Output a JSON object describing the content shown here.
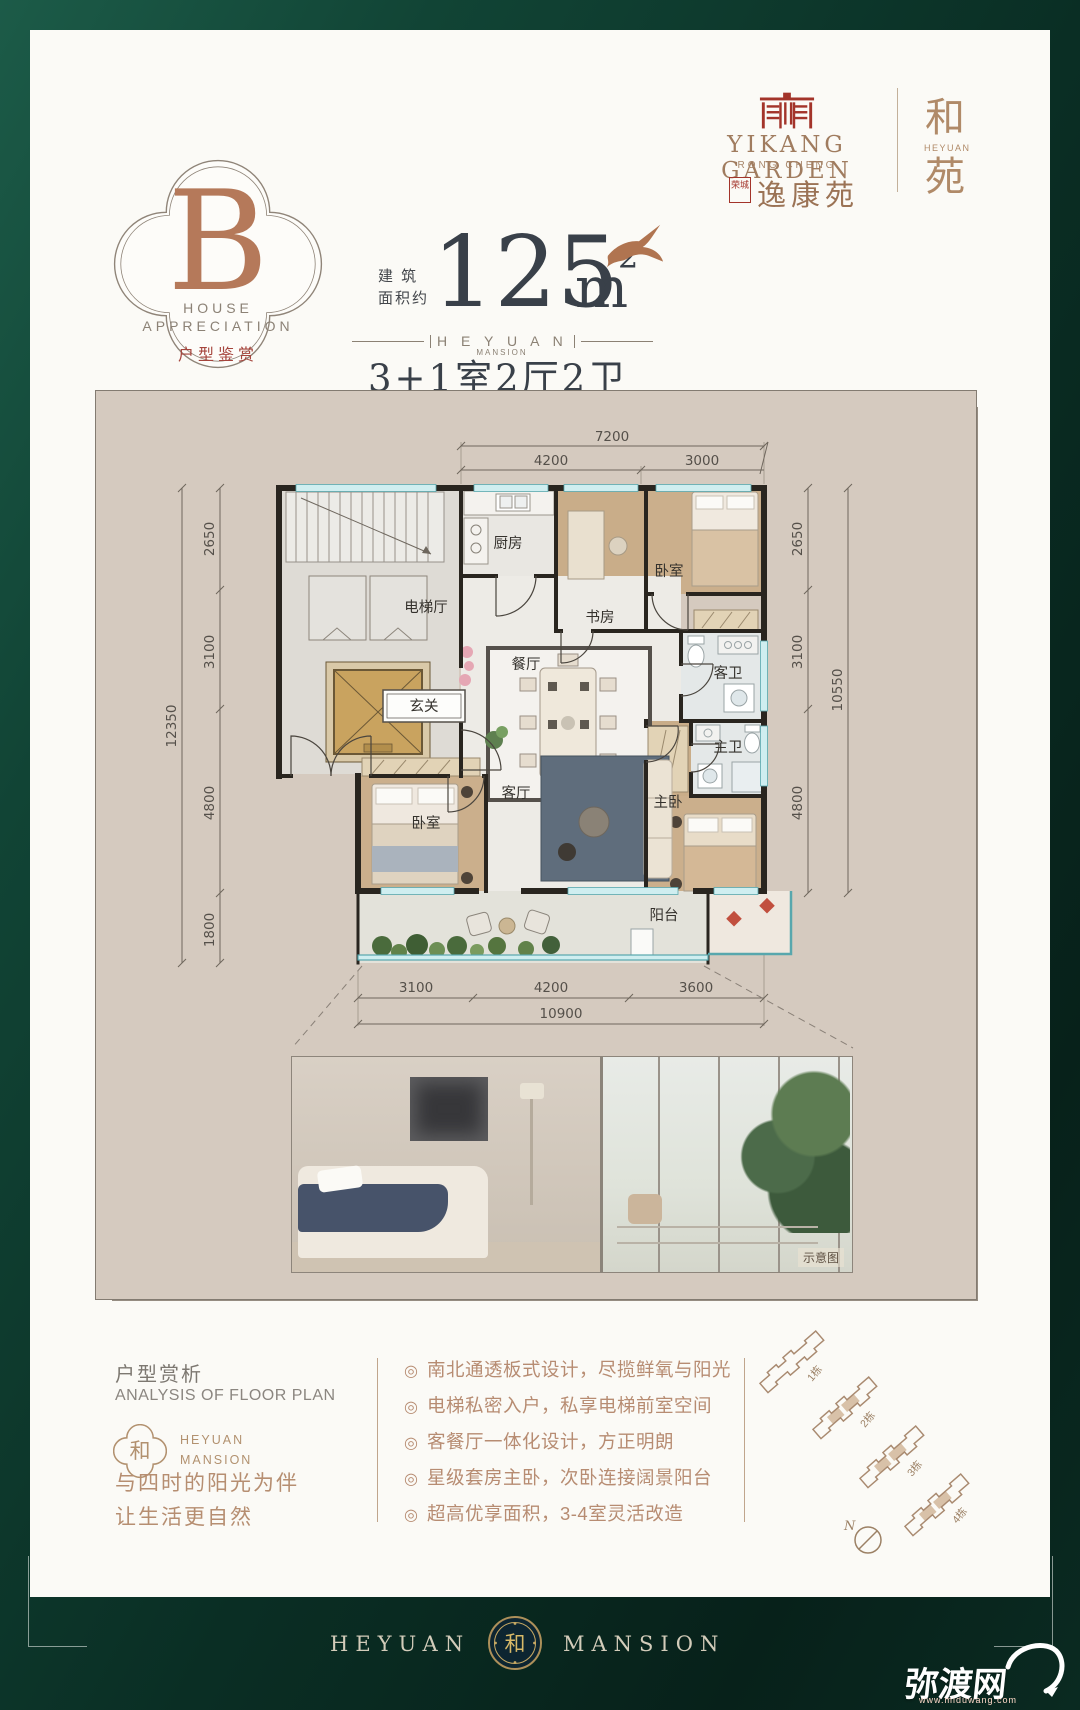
{
  "colors": {
    "background_green": "#0c3a2d",
    "accent_red": "#a3342a",
    "brand_brown": "#a07c5f",
    "panel_beige": "#d5cabf",
    "wall_black": "#29251f",
    "window_teal": "#7fccd3",
    "elevator_gold": "#c9a35f"
  },
  "brand": {
    "name_en": "YIKANG GARDEN",
    "sub_en": "RONG CHENG",
    "seal": "荣城",
    "name_cn": "逸康苑",
    "side_top": "和",
    "side_en": "HEYUAN",
    "side_bottom": "苑"
  },
  "badge": {
    "letter": "B",
    "en1": "HOUSE",
    "en2": "APPRECIATION",
    "cn": "户型鉴赏"
  },
  "area": {
    "prefix1": "建 筑",
    "prefix2": "面积约",
    "value": "125",
    "unit": "m",
    "sup": "2",
    "brand_en": "H E Y U A N",
    "brand_sub": "MANSION",
    "layout": "3+1室2厅2卫"
  },
  "floorplan": {
    "dims": {
      "top": {
        "total": "7200",
        "segs": [
          "4200",
          "3000"
        ]
      },
      "left": {
        "total": "12350",
        "segs": [
          "2650",
          "3100",
          "4800",
          "1800"
        ]
      },
      "right": {
        "total": "10550",
        "segs": [
          "2650",
          "3100",
          "4800"
        ]
      },
      "bottom": {
        "total": "10900",
        "segs": [
          "3100",
          "4200",
          "3600"
        ]
      }
    },
    "rooms": {
      "kitchen": "厨房",
      "study": "书房",
      "bedroom_top": "卧室",
      "elevator_hall": "电梯厅",
      "dining": "餐厅",
      "guest_bath": "客卫",
      "foyer": "玄关",
      "bedroom2": "卧室",
      "living": "客厅",
      "master_bath": "主卫",
      "master_bedroom": "主卧",
      "balcony": "阳台"
    },
    "photo_tag": "示意图"
  },
  "analysis": {
    "title_cn": "户型赏析",
    "title_en": "ANALYSIS OF FLOOR PLAN",
    "logo_char": "和",
    "logo_en1": "HEYUAN",
    "logo_en2": "MANSION",
    "slogan1": "与四时的阳光为伴",
    "slogan2": "让生活更自然",
    "bullet_icon": "◎",
    "bullets": [
      "南北通透板式设计，尽揽鲜氧与阳光",
      "电梯私密入户，私享电梯前室空间",
      "客餐厅一体化设计，方正明朗",
      "星级套房主卧，次卧连接阔景阳台",
      "超高优享面积，3-4室灵活改造"
    ]
  },
  "siteplan": {
    "buildings": [
      "1栋",
      "2栋",
      "3栋",
      "4栋"
    ],
    "compass": "N"
  },
  "footer": {
    "left": "HEYUAN",
    "right": "MANSION",
    "medallion": "和"
  },
  "watermark": {
    "name": "弥渡网",
    "url": "www.miduwang.com"
  }
}
